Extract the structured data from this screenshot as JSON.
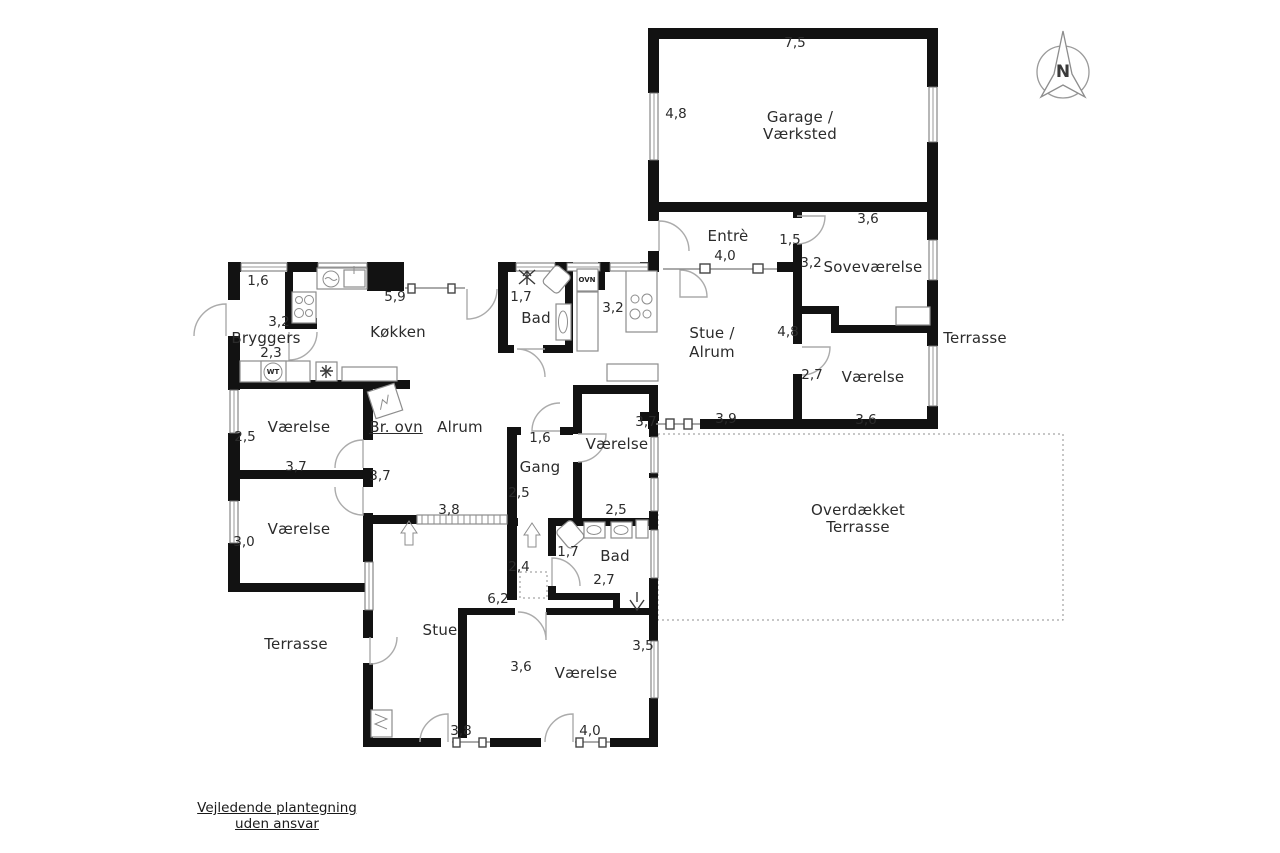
{
  "plan_title": "Floor plan",
  "compass": {
    "label": "N"
  },
  "rooms": {
    "garage_line1": "Garage /",
    "garage_line2": "Værksted",
    "entre": "Entrè",
    "sovevaerelse": "Soveværelse",
    "terrasse_east": "Terrasse",
    "stue_alrum_line1": "Stue /",
    "stue_alrum_line2": "Alrum",
    "vaerelse_east": "Værelse",
    "bryggers": "Bryggers",
    "koekken": "Køkken",
    "bad_north": "Bad",
    "vaerelse_nw": "Værelse",
    "br_ovn": "Br. ovn",
    "alrum": "Alrum",
    "vaerelse_mid": "Værelse",
    "gang": "Gang",
    "vaerelse_sw": "Værelse",
    "overdaekket_line1": "Overdækket",
    "overdaekket_line2": "Terrasse",
    "bad_south": "Bad",
    "terrasse_west": "Terrasse",
    "stue": "Stue",
    "vaerelse_south": "Værelse"
  },
  "dims": {
    "garage_w": "7,5",
    "garage_h": "4,8",
    "sove_win": "3,6",
    "entre_door": "1,5",
    "entre_w": "4,0",
    "sove_h": "3,2",
    "bryggers_win": "1,6",
    "koekken_w": "5,9",
    "bad_n_w": "1,7",
    "island": "3,2",
    "bryggers_w": "3,2",
    "stue_alrum_h": "4,8",
    "bryggers_s": "2,3",
    "vaerelse_e_h": "2,7",
    "alrum_s_door": "3,9",
    "vaerelse_e_w": "3,6",
    "vaerelse_mid_w": "3,7",
    "vaerelse_nw_h": "2,5",
    "gang_n": "1,6",
    "vaerelse_nw_w": "3,7",
    "alrum_w": "3,7",
    "gang_h": "2,5",
    "vaerelse_mid_h": "2,5",
    "alrum_stue_door": "3,8",
    "vaerelse_sw_h": "3,0",
    "bad_s_n": "1,7",
    "hall_s": "2,4",
    "bad_s_w": "2,7",
    "stue_h": "6,2",
    "vaerelse_s_ne": "3,5",
    "vaerelse_s_h": "3,6",
    "stue_door": "3,8",
    "vaerelse_s_door": "4,0"
  },
  "fixtures": {
    "oven": "OVN",
    "washer": "WT"
  },
  "footer": {
    "line1": "Vejledende plantegning",
    "line2": "uden ansvar"
  },
  "colors": {
    "wall": "#121212",
    "text": "#2b2b2b",
    "door": "#ababab",
    "dashed": "#8f8f8f"
  }
}
